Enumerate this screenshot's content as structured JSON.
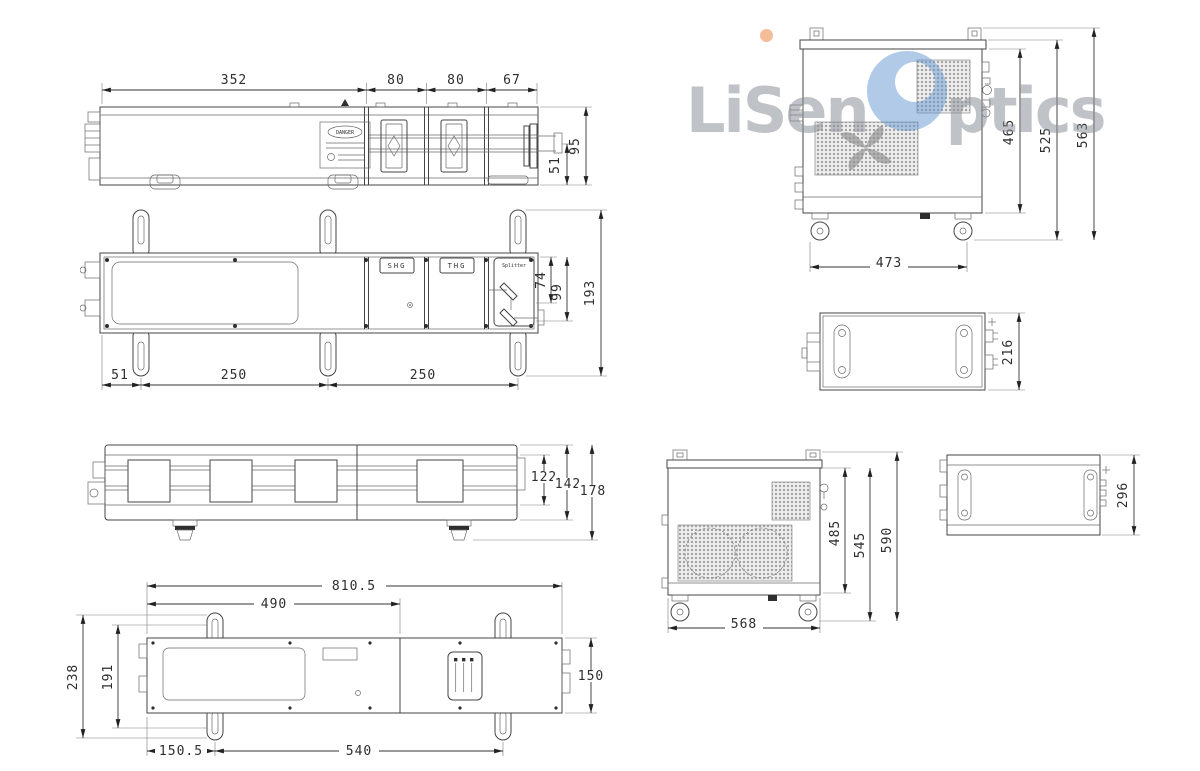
{
  "logo": {
    "l": "L",
    "i": "i",
    "sen": "Sen",
    "ptics": "ptics"
  },
  "head_side": {
    "dims_top": [
      "352",
      "80",
      "80",
      "67"
    ],
    "dim_95": "95",
    "dim_51": "51",
    "danger": "DANGER"
  },
  "head_top": {
    "shg": "SHG",
    "thg": "THG",
    "splitter": "Splitter",
    "dim_74": "74",
    "dim_99": "99",
    "dim_193": "193",
    "dims_bottom": [
      "51",
      "250",
      "250"
    ]
  },
  "head_front": {
    "dims_right": [
      "122",
      "142",
      "178"
    ]
  },
  "head_bottom": {
    "dim_810": "810.5",
    "dim_490": "490",
    "dim_238": "238",
    "dim_191": "191",
    "dim_150": "150",
    "dim_150_5": "150.5",
    "dim_540": "540"
  },
  "chiller_side": {
    "dim_465": "465",
    "dim_525": "525",
    "dim_563": "563",
    "dim_473": "473"
  },
  "psu_top": {
    "dim_216": "216"
  },
  "chiller_front": {
    "dim_485": "485",
    "dim_545": "545",
    "dim_590": "590",
    "dim_568": "568"
  },
  "psu_side": {
    "dim_296": "296"
  }
}
